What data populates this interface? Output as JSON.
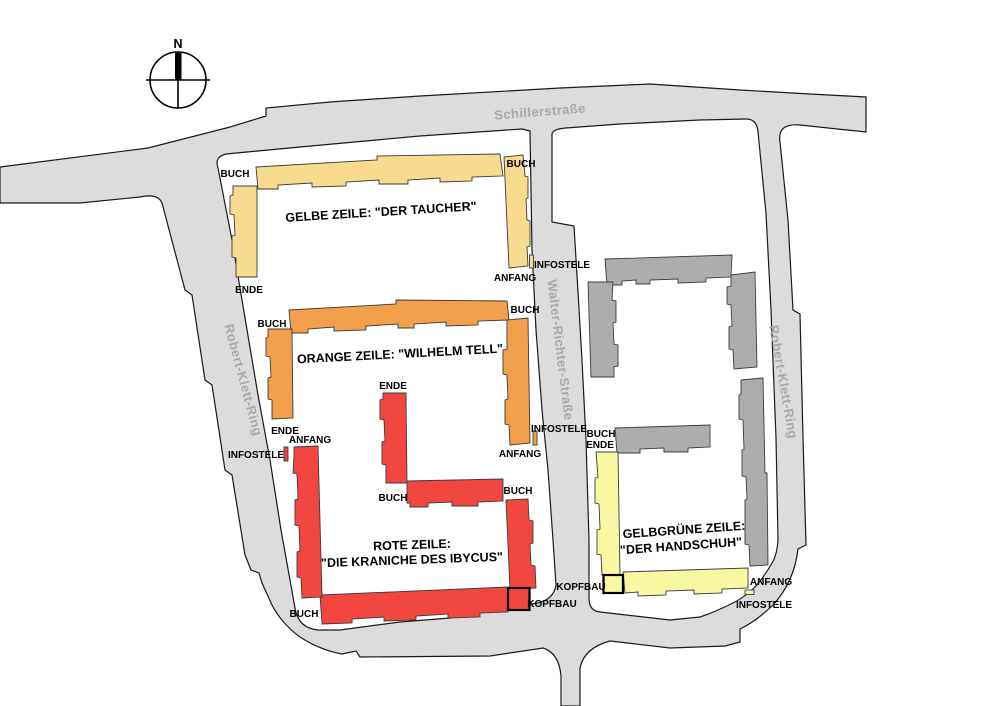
{
  "map": {
    "compass_north": "N",
    "streets": {
      "top": "Schillerstraße",
      "middle": "Walter-Richter-Straße",
      "left_ring": "Robert-Klett-Ring",
      "right_ring": "Robert-Klett-Ring"
    },
    "rows": {
      "gelbe": {
        "title": "GELBE ZEILE: \"DER TAUCHER\""
      },
      "orange": {
        "title": "ORANGE ZEILE: \"WILHELM TELL\""
      },
      "rote": {
        "title_line1": "ROTE ZEILE:",
        "title_line2": "\"DIE KRANICHE DES IBYCUS\""
      },
      "gelbgruene": {
        "title_line1": "GELBGRÜNE ZEILE:",
        "title_line2": "\"DER HANDSCHUH\""
      }
    },
    "terms": {
      "buch": "BUCH",
      "ende": "ENDE",
      "anfang": "ANFANG",
      "infostele": "INFOSTELE",
      "kopfbau": "KOPFBAU"
    },
    "colors": {
      "street": "#DCDCDC",
      "street_label": "#A9A9A9",
      "yellow_row": "#F8DB8E",
      "orange_row": "#F2A04B",
      "red_row": "#F2473F",
      "gray_building": "#ADADAD",
      "yellowgreen_row": "#F8F8A2",
      "background": "#FFFFFF"
    }
  }
}
